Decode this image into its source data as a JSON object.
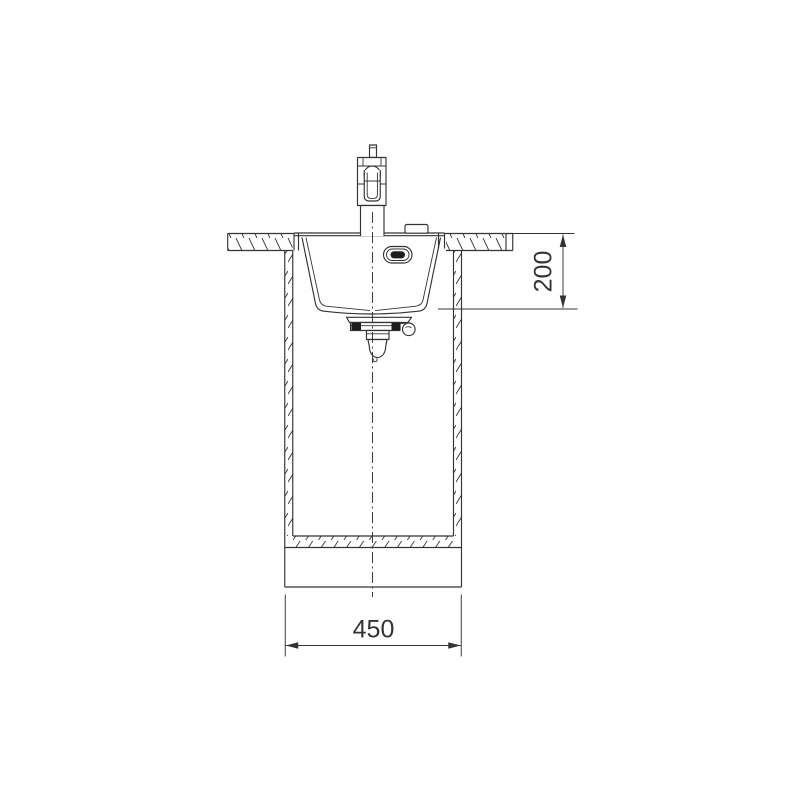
{
  "diagram": {
    "dimensions": {
      "width_mm": "450",
      "depth_mm": "200"
    },
    "colors": {
      "line": "#333333",
      "dark_fill": "#1d1d1d",
      "background": "#ffffff"
    }
  }
}
